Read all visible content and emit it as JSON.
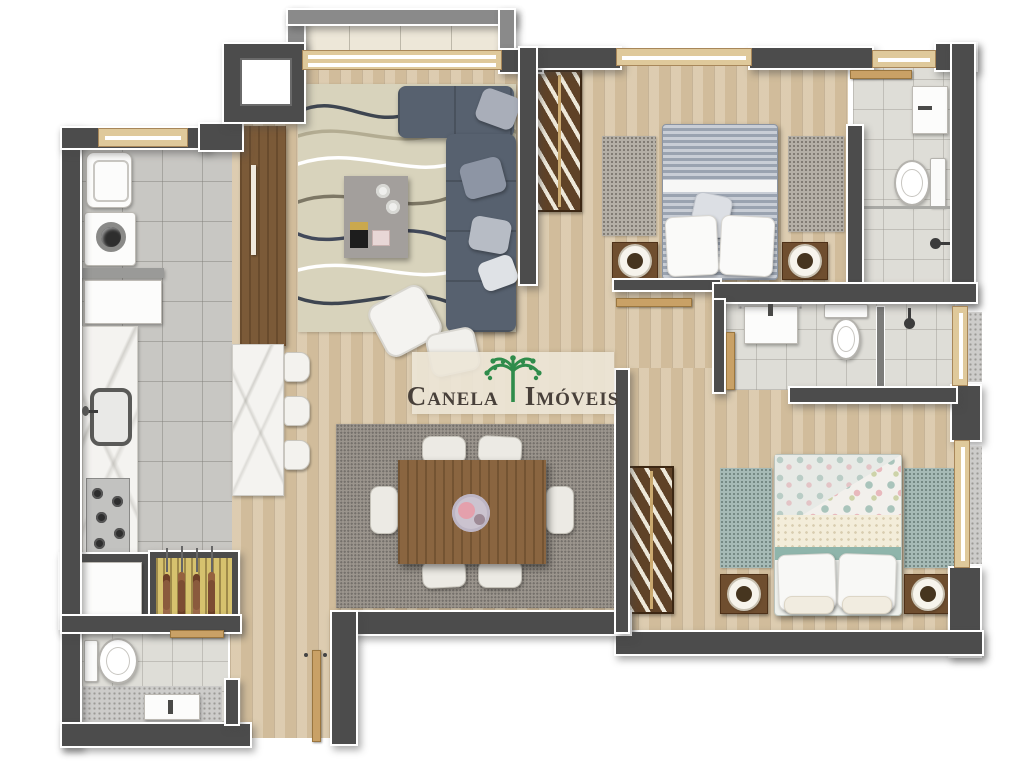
{
  "watermark": {
    "word1": "Canela",
    "word2": "Imóveis",
    "logo": "araucaria-tree-icon"
  },
  "palette": {
    "wall": "#4c4c4c",
    "wall_outline": "#ffffff",
    "balcony_wall": "#8a8a8a",
    "wood_floor": "#d8c5a5",
    "kitchen_tile": "#c8c7c3",
    "bath_tile": "#deddd7",
    "balcony_floor": "#ede7d8",
    "marble": "#f4f3f0",
    "granite": "#cdccca",
    "sofa": "#57616f",
    "living_rug": "#d8d3bc",
    "dining_rug": "#9b958d",
    "table_wood": "#8a6540",
    "wardrobe_wood": "#5f4227",
    "door_wood": "#c9a166",
    "bed1_duvet": "#9aa3b0",
    "bed2_accent": "#8fb5ab",
    "grill": "#d6c26e",
    "logo_green": "#2f8c4b",
    "watermark_text": "#48403a"
  },
  "rooms": [
    {
      "name": "balcony",
      "furniture": []
    },
    {
      "name": "living-room",
      "furniture": [
        "sliding-door",
        "wavy-pattern-rug",
        "l-shaped-sofa",
        "throw-pillows",
        "coffee-table",
        "lounge-chair",
        "ottoman",
        "tall-cabinet"
      ]
    },
    {
      "name": "laundry-area",
      "furniture": [
        "window",
        "laundry-tub",
        "washing-machine",
        "counter",
        "cabinet"
      ]
    },
    {
      "name": "kitchen",
      "furniture": [
        "marble-counter",
        "sink",
        "faucet",
        "cooktop",
        "island-counter",
        "bar-stool",
        "bar-stool",
        "bar-stool",
        "barbecue-grill",
        "skewers",
        "niche-cabinet"
      ]
    },
    {
      "name": "lavabo",
      "furniture": [
        "toilet",
        "washbasin",
        "door"
      ]
    },
    {
      "name": "entry-hall",
      "furniture": [
        "front-door"
      ]
    },
    {
      "name": "dining-area",
      "furniture": [
        "rug",
        "dining-table",
        "serving-plate",
        "chair",
        "chair",
        "chair",
        "chair",
        "chair",
        "chair"
      ]
    },
    {
      "name": "hallway",
      "furniture": []
    },
    {
      "name": "bedroom-1",
      "furniture": [
        "window",
        "wardrobe",
        "double-bed",
        "pillows",
        "nightstand",
        "nightstand",
        "lamp",
        "lamp",
        "rug",
        "rug",
        "door"
      ]
    },
    {
      "name": "ensuite-bathroom",
      "furniture": [
        "window",
        "vanity-sink",
        "toilet",
        "glass-partition",
        "shower",
        "door"
      ]
    },
    {
      "name": "bathroom-2",
      "furniture": [
        "vanity-sink",
        "toilet",
        "partition",
        "shower",
        "window",
        "door"
      ]
    },
    {
      "name": "bedroom-2",
      "furniture": [
        "wardrobe",
        "double-bed",
        "pillows",
        "nightstand",
        "nightstand",
        "lamp",
        "lamp",
        "rug",
        "rug",
        "window"
      ]
    }
  ]
}
